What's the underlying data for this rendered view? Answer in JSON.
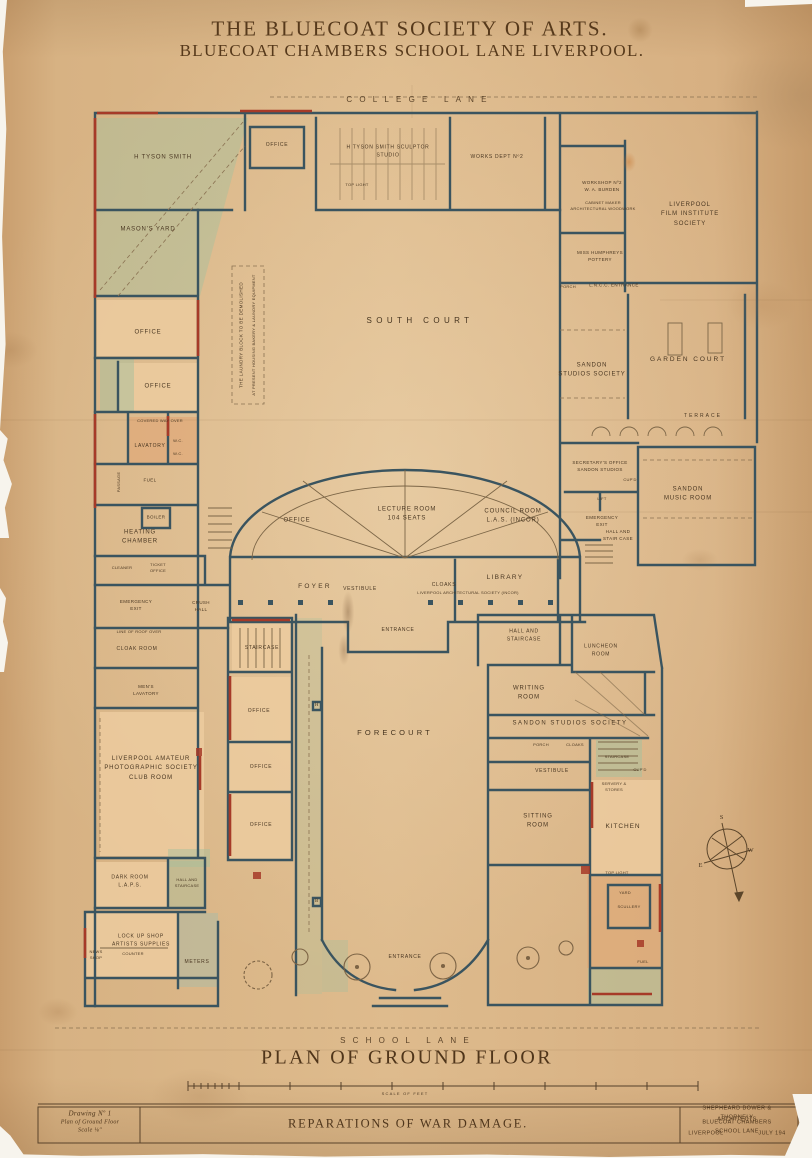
{
  "header": {
    "line1": "THE BLUECOAT SOCIETY OF ARTS.",
    "line2": "BLUECOAT CHAMBERS SCHOOL LANE LIVERPOOL."
  },
  "streets": {
    "college_lane": "COLLEGE LANE",
    "school_lane": "SCHOOL LANE"
  },
  "courts": {
    "south_court": "SOUTH COURT",
    "forecourt": "FORECOURT",
    "garden_court": "GARDEN COURT",
    "terrace": "TERRACE"
  },
  "rooms": {
    "office_tl": "OFFICE",
    "tyson_room": "H TYSON SMITH",
    "tyson_studio": "H TYSON SMITH  SCULPTOR\nSTUDIO",
    "top_light_studio": "TOP LIGHT",
    "works_dept": "WORKS DEPT Nº2",
    "masons_yard": "MASON'S YARD",
    "burden_shop": "WORKSHOP Nº2\nW. A. BURDEN",
    "cabinet_maker": "CABINET MAKER\nARCHITECTURAL WOODWORK",
    "pottery": "MISS HUMPHREYS\nPOTTERY",
    "film_institute": "LIVERPOOL\nFILM INSTITUTE\nSOCIETY",
    "porch_ne": "PORCH",
    "lncc_entrance": "L.N.C.C. ENTRANCE",
    "sandon_studios": "SANDON\nSTUDIOS SOCIETY",
    "secretarys_office": "SECRETARY'S OFFICE\nSANDON STUDIOS",
    "lift": "LIFT",
    "cupd_r": "CUP'D",
    "emergency_exit_r": "EMERGENCY\nEXIT",
    "hall_staircase_r": "HALL AND\nSTAIR CASE",
    "music_room": "SANDON\nMUSIC ROOM",
    "office_arc": "OFFICE",
    "lecture_room": "LECTURE ROOM\n104 SEATS",
    "council_room": "COUNCIL ROOM\nL.A.S. (INCOR)",
    "foyer": "FOYER",
    "vestibule_c": "VESTIBULE",
    "cloaks_c": "CLOAKS",
    "library": "LIBRARY",
    "library_society": "LIVERPOOL ARCHITECTURAL SOCIETY (INCOR)",
    "entrance_c": "ENTRANCE",
    "heating_chamber": "HEATING\nCHAMBER",
    "boiler": "BOILER",
    "cleaner": "CLEANER",
    "ticket_office": "TICKET\nOFFICE",
    "lavatory": "LAVATORY",
    "wc1": "W.C.",
    "wc2": "W.C.",
    "fuel_l": "FUEL",
    "office_l1": "OFFICE",
    "office_l2": "OFFICE",
    "emergency_exit_l": "EMERGENCY\nEXIT",
    "crush_hall": "CRUSH\nHALL",
    "cloak_room": "CLOAK ROOM",
    "mens_lavatory": "MEN'S\nLAVATORY",
    "staircase_c": "STAIRCASE",
    "office_c1": "OFFICE",
    "office_c2": "OFFICE",
    "office_c3": "OFFICE",
    "photo_club": "LIVERPOOL AMATEUR\nPHOTOGRAPHIC SOCIETY\nCLUB ROOM",
    "dark_room": "DARK ROOM\nL.A.P.S.",
    "hall_staircase_sw": "HALL AND\nSTAIRCASE",
    "lockup_shop": "LOCK UP SHOP\nARTISTS SUPPLIES",
    "counter": "COUNTER",
    "news_shop": "NEWS\nSHOP",
    "meters": "METERS",
    "hall_staircase_se": "HALL AND\nSTAIRCASE",
    "luncheon_room": "LUNCHEON\nROOM",
    "writing_room": "WRITING\nROOM",
    "sandon_band": "SANDON STUDIOS SOCIETY",
    "porch_se": "PORCH",
    "cloaks_se": "CLOAKS",
    "vestibule_se": "VESTIBULE",
    "sitting_room": "SITTING\nROOM",
    "kitchen": "KITCHEN",
    "staircase_se": "STAIRCASE",
    "cupd_se": "CUP'D",
    "servery": "SERVERY &\nSTORES",
    "top_light_k": "TOP LIGHT",
    "yard_se": "YARD",
    "scullery": "SCULLERY",
    "fuel_se": "FUEL",
    "entrance_s": "ENTRANCE"
  },
  "annotations": {
    "laundry_note_1": "THE LAUNDRY BLOCK TO BE DEMOLISHED",
    "laundry_note_2": "AT PRESENT HOUSING BAKERY & LAUNDRY EQUIPMENT",
    "covered_way": "COVERED WAY OVER",
    "line_of_roof": "LINE OF ROOF OVER",
    "passage": "PASSAGE"
  },
  "markers": {
    "h": "H",
    "b": "B",
    "compass_s": "S",
    "compass_e": "E",
    "compass_w": "W"
  },
  "footer": {
    "plan_title": "PLAN OF GROUND FLOOR",
    "scale_caption": "SCALE OF FEET"
  },
  "title_block": {
    "drawing_no": "Drawing Nº 1",
    "drawing_name": "Plan of Ground Floor",
    "drawing_scale": "Scale ⅛″",
    "subject": "REPARATIONS OF WAR DAMAGE.",
    "architect_line1": "SHEPHEARD BOWER & THORNELY",
    "architect_line2": "ARCHITECTS",
    "architect_line3": "BLUECOAT CHAMBERS SCHOOL LANE",
    "architect_city": "LIVERPOOL",
    "architect_date": "JULY 194"
  },
  "colors": {
    "paper": "#d8b486",
    "wall_ink": "#3a545f",
    "damage_red": "#a63a28",
    "room_wash": "#eccb9f",
    "green_wash": "#a9bf9c",
    "text_ink": "#4a3722"
  }
}
